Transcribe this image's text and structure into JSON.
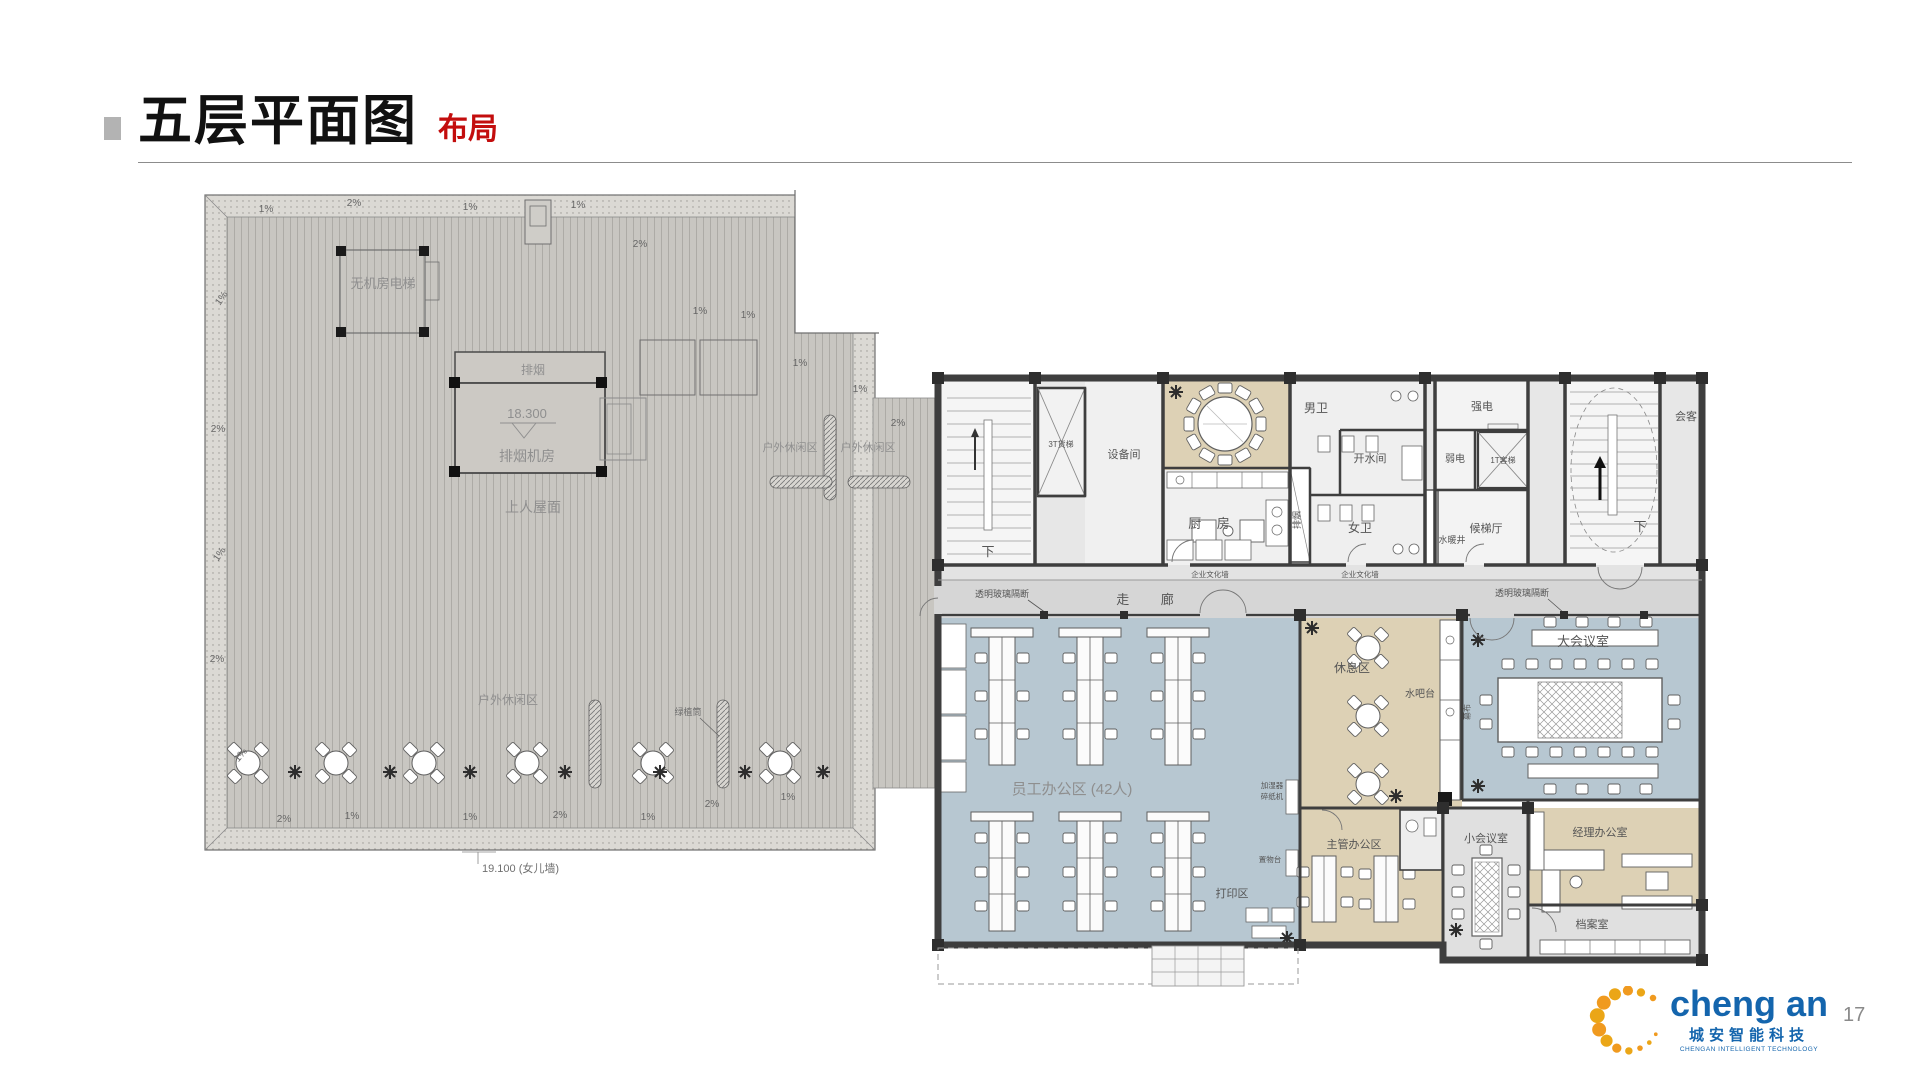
{
  "header": {
    "title": "五层平面图",
    "subtitle": "布局"
  },
  "page": {
    "page_number": "17"
  },
  "logo": {
    "brand": "cheng an",
    "company_cn": "城安智能科技",
    "company_en": "CHENGAN INTELLIGENT TECHNOLOGY"
  },
  "roof": {
    "labels": {
      "mrl_elevator": "无机房电梯",
      "smoke_vent": "排烟",
      "elevation": "18.300",
      "smoke_room": "排烟机房",
      "walkable_roof": "上人屋面",
      "outdoor_leisure": "户外休闲区",
      "planter": "绿植筒",
      "parapet_elevation": "19.100 (女儿墙)"
    },
    "slopes": [
      "1%",
      "2%",
      "1%",
      "2%",
      "1%",
      "1%",
      "2%",
      "1%",
      "1%",
      "2%",
      "1%",
      "1%",
      "1%",
      "1%",
      "2%",
      "2%",
      "1%",
      "1%",
      "2%",
      "1%",
      "2%",
      "1%"
    ]
  },
  "floor": {
    "rooms": {
      "freight_elevator": "3T货梯",
      "equipment_room": "设备间",
      "mens_wc": "男卫",
      "hot_water_room": "开水间",
      "womens_wc": "女卫",
      "kitchen": "厨 房",
      "smoke_duct": "排烟",
      "strong_power": "强电",
      "weak_power": "弱电",
      "passenger_elevator": "1T客梯",
      "elevator_lobby": "候梯厅",
      "plumbing_shaft": "水暖井",
      "reception": "会客",
      "stairs_down": "下",
      "corridor": "走 廊",
      "staff_office": "员工办公区 (42人)",
      "print_area": "打印区",
      "rest_area": "休息区",
      "water_bar": "水吧台",
      "large_meeting_room": "大会议室",
      "projection_screen": "幕布",
      "supervisor_office": "主管办公区",
      "small_meeting_room": "小会议室",
      "manager_office": "经理办公室",
      "archive_room": "档案室"
    },
    "annotations": {
      "glass_partition": "透明玻璃隔断",
      "culture_wall": "企业文化墙",
      "humidifier": "加湿器",
      "shredder": "碎纸机",
      "shelf_table": "置物台"
    }
  }
}
